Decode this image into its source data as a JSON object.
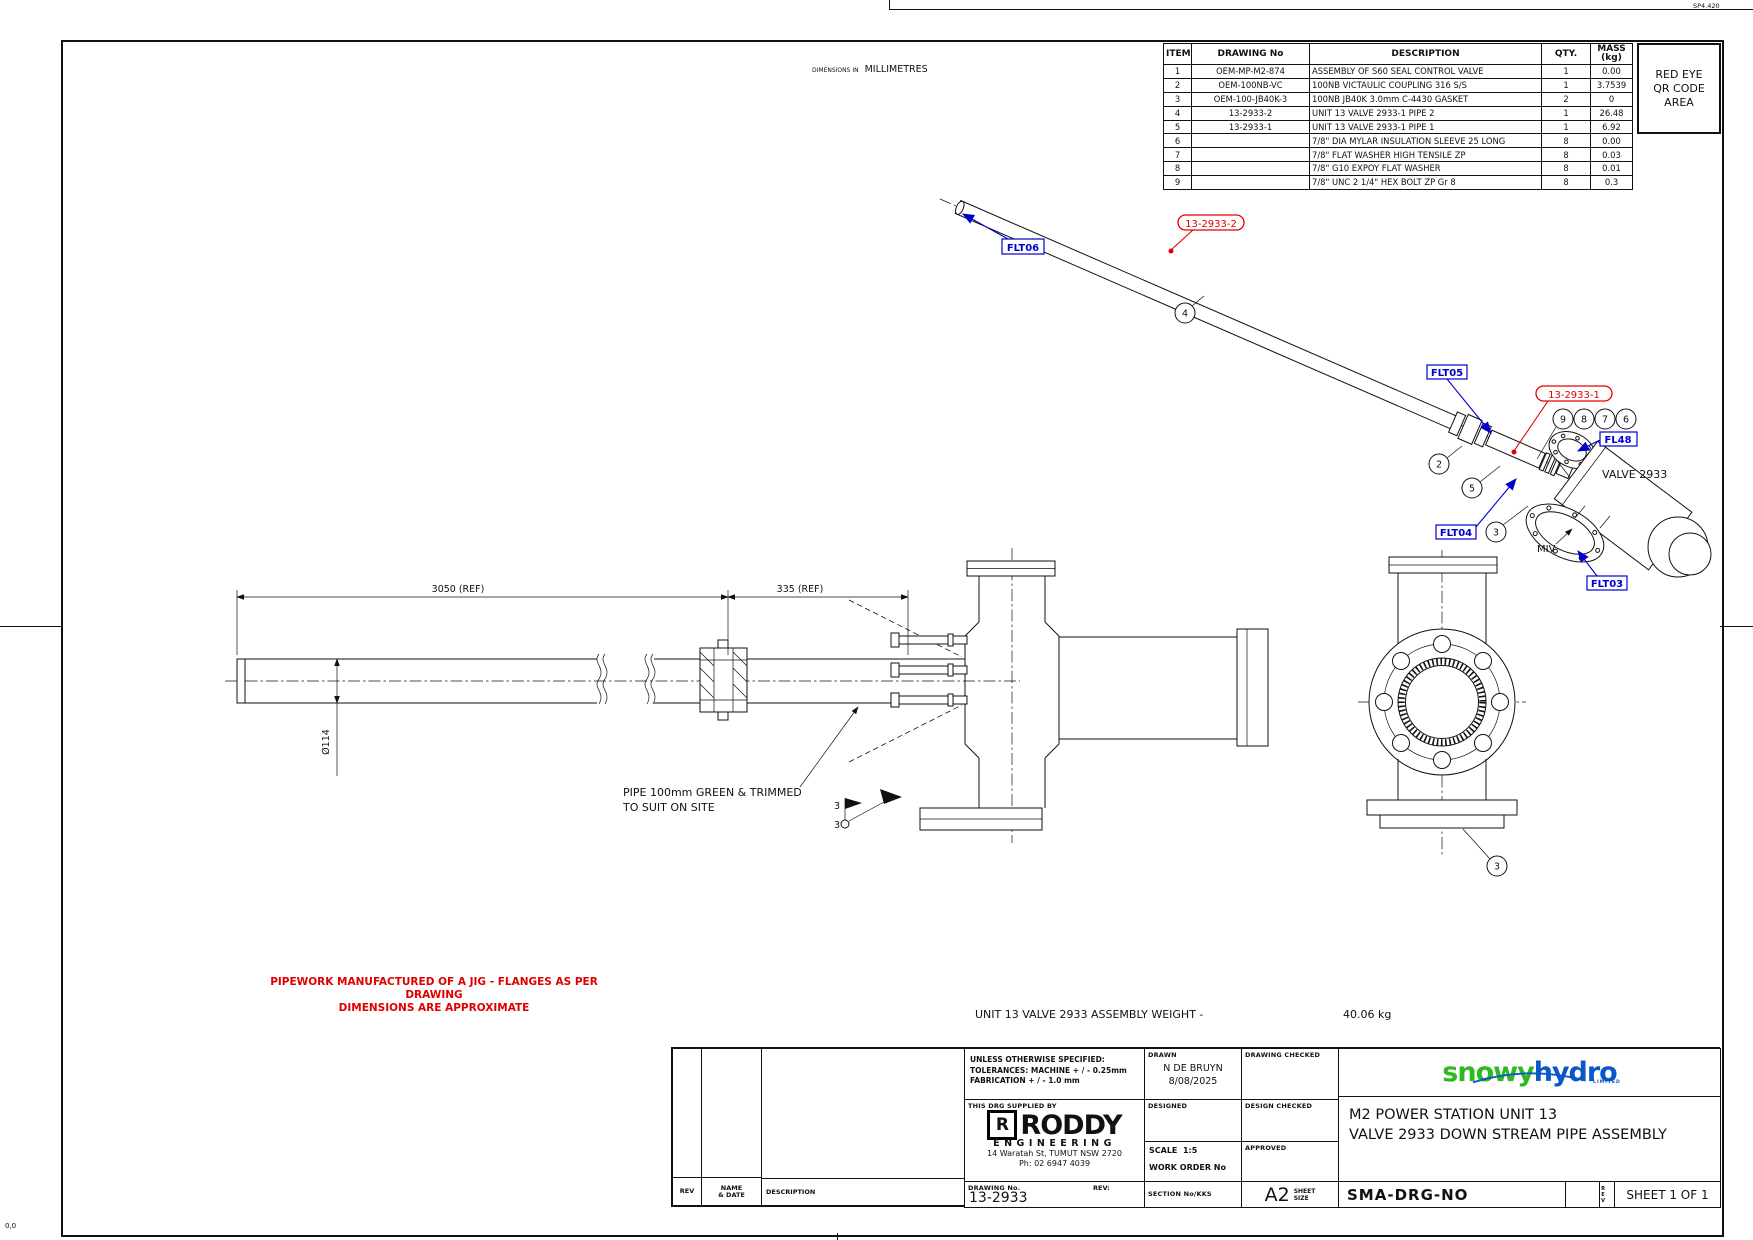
{
  "page": {
    "corner_code": "SP4.420",
    "origin_mark": "0,0",
    "dims_in": "DIMENSIONS IN",
    "units": "MILLIMETRES"
  },
  "colors": {
    "line": "#111111",
    "label_blue": "#0000cd",
    "accent_red": "#e00000",
    "brand_green": "#2eb91e",
    "brand_blue": "#0a58c8"
  },
  "bom": {
    "headers": {
      "item": "ITEM",
      "drawing_no": "DRAWING No",
      "description": "DESCRIPTION",
      "qty": "QTY.",
      "mass_1": "MASS",
      "mass_2": "(kg)"
    },
    "rows": [
      {
        "item": "1",
        "dwg": "OEM-MP-M2-874",
        "desc": "ASSEMBLY OF S60 SEAL CONTROL VALVE",
        "qty": "1",
        "mass": "0.00"
      },
      {
        "item": "2",
        "dwg": "OEM-100NB-VC",
        "desc": "100NB VICTAULIC COUPLING 316 S/S",
        "qty": "1",
        "mass": "3.7539"
      },
      {
        "item": "3",
        "dwg": "OEM-100-JB40K-3",
        "desc": "100NB JB40K 3.0mm C-4430 GASKET",
        "qty": "2",
        "mass": "0"
      },
      {
        "item": "4",
        "dwg": "13-2933-2",
        "desc": "UNIT 13 VALVE 2933-1 PIPE 2",
        "qty": "1",
        "mass": "26.48"
      },
      {
        "item": "5",
        "dwg": "13-2933-1",
        "desc": "UNIT 13 VALVE 2933-1 PIPE 1",
        "qty": "1",
        "mass": "6.92"
      },
      {
        "item": "6",
        "dwg": "",
        "desc": "7/8\" DIA MYLAR INSULATION SLEEVE 25 LONG",
        "qty": "8",
        "mass": "0.00"
      },
      {
        "item": "7",
        "dwg": "",
        "desc": "7/8\" FLAT WASHER HIGH TENSILE ZP",
        "qty": "8",
        "mass": "0.03"
      },
      {
        "item": "8",
        "dwg": "",
        "desc": "7/8\" G10 EXPOY FLAT WASHER",
        "qty": "8",
        "mass": "0.01"
      },
      {
        "item": "9",
        "dwg": "",
        "desc": "7/8\" UNC 2 1/4\" HEX BOLT ZP Gr 8",
        "qty": "8",
        "mass": "0.3"
      }
    ]
  },
  "qr_area": {
    "line1": "RED EYE",
    "line2": "QR CODE",
    "line3": "AREA"
  },
  "labels": {
    "flt06": "FLT06",
    "flt05": "FLT05",
    "flt04": "FLT04",
    "flt03": "FLT03",
    "fl48": "FL48",
    "tag_pipe2": "13-2933-2",
    "tag_pipe1": "13-2933-1",
    "valve_name": "VALVE 2933",
    "miv": "MIV"
  },
  "balloons": {
    "b2": "2",
    "b3": "3",
    "b3_flange": "3",
    "b4": "4",
    "b5": "5",
    "b6": "6",
    "b7": "7",
    "b8": "8",
    "b9": "9"
  },
  "dims": {
    "overall": "3050 (REF)",
    "stub": "335 (REF)",
    "bore": "Ø114"
  },
  "notes": {
    "red_1": "PIPEWORK MANUFACTURED OF A JIG - FLANGES AS PER DRAWING",
    "red_2": "DIMENSIONS ARE APPROXIMATE",
    "pipe_note_1": "PIPE 100mm GREEN & TRIMMED",
    "pipe_note_2": "TO SUIT ON SITE",
    "weld_upper": "3",
    "weld_lower": "3",
    "weight_label": "UNIT 13 VALVE 2933 ASSEMBLY WEIGHT -",
    "weight_value": "40.06 kg"
  },
  "titleblock": {
    "tolerances": {
      "l1": "UNLESS OTHERWISE SPECIFIED:",
      "l2": "TOLERANCES: MACHINE + / - 0.25mm",
      "l3": "FABRICATION + / - 1.0 mm"
    },
    "supplied_by_label": "THIS DRG SUPPLIED BY",
    "roddy": {
      "mark": "R",
      "name": "RODDY",
      "sub": "ENGINEERING",
      "addr1": "14 Waratah St, TUMUT NSW 2720",
      "addr2": "Ph: 02 6947 4039"
    },
    "drawing_no_label": "DRAWING No.",
    "drawing_no": "13-2933",
    "rev_label": "REV:",
    "drawn_label": "DRAWN",
    "drawn_name": "N DE BRUYN",
    "drawn_date": "8/08/2025",
    "designed_label": "DESIGNED",
    "drawing_checked_label": "DRAWING CHECKED",
    "design_checked_label": "DESIGN CHECKED",
    "approved_label": "APPROVED",
    "scale_label": "SCALE",
    "scale_value": "1:5",
    "work_order_label": "WORK ORDER No",
    "section_label": "SECTION No/KKS",
    "size_value": "A2",
    "size_label_1": "SHEET",
    "size_label_2": "SIZE",
    "brand": {
      "part1": "snowy",
      "part2": "hydro",
      "limited": "LIMITED"
    },
    "title_line1": "M2 POWER STATION UNIT 13",
    "title_line2": "VALVE 2933 DOWN STREAM PIPE ASSEMBLY",
    "sma": "SMA-DRG-NO",
    "rev_vertical": "REV",
    "sheet": "SHEET 1 OF 1",
    "rev_col": "REV",
    "name_col_1": "NAME",
    "name_col_2": "& DATE",
    "desc_col": "DESCRIPTION"
  }
}
